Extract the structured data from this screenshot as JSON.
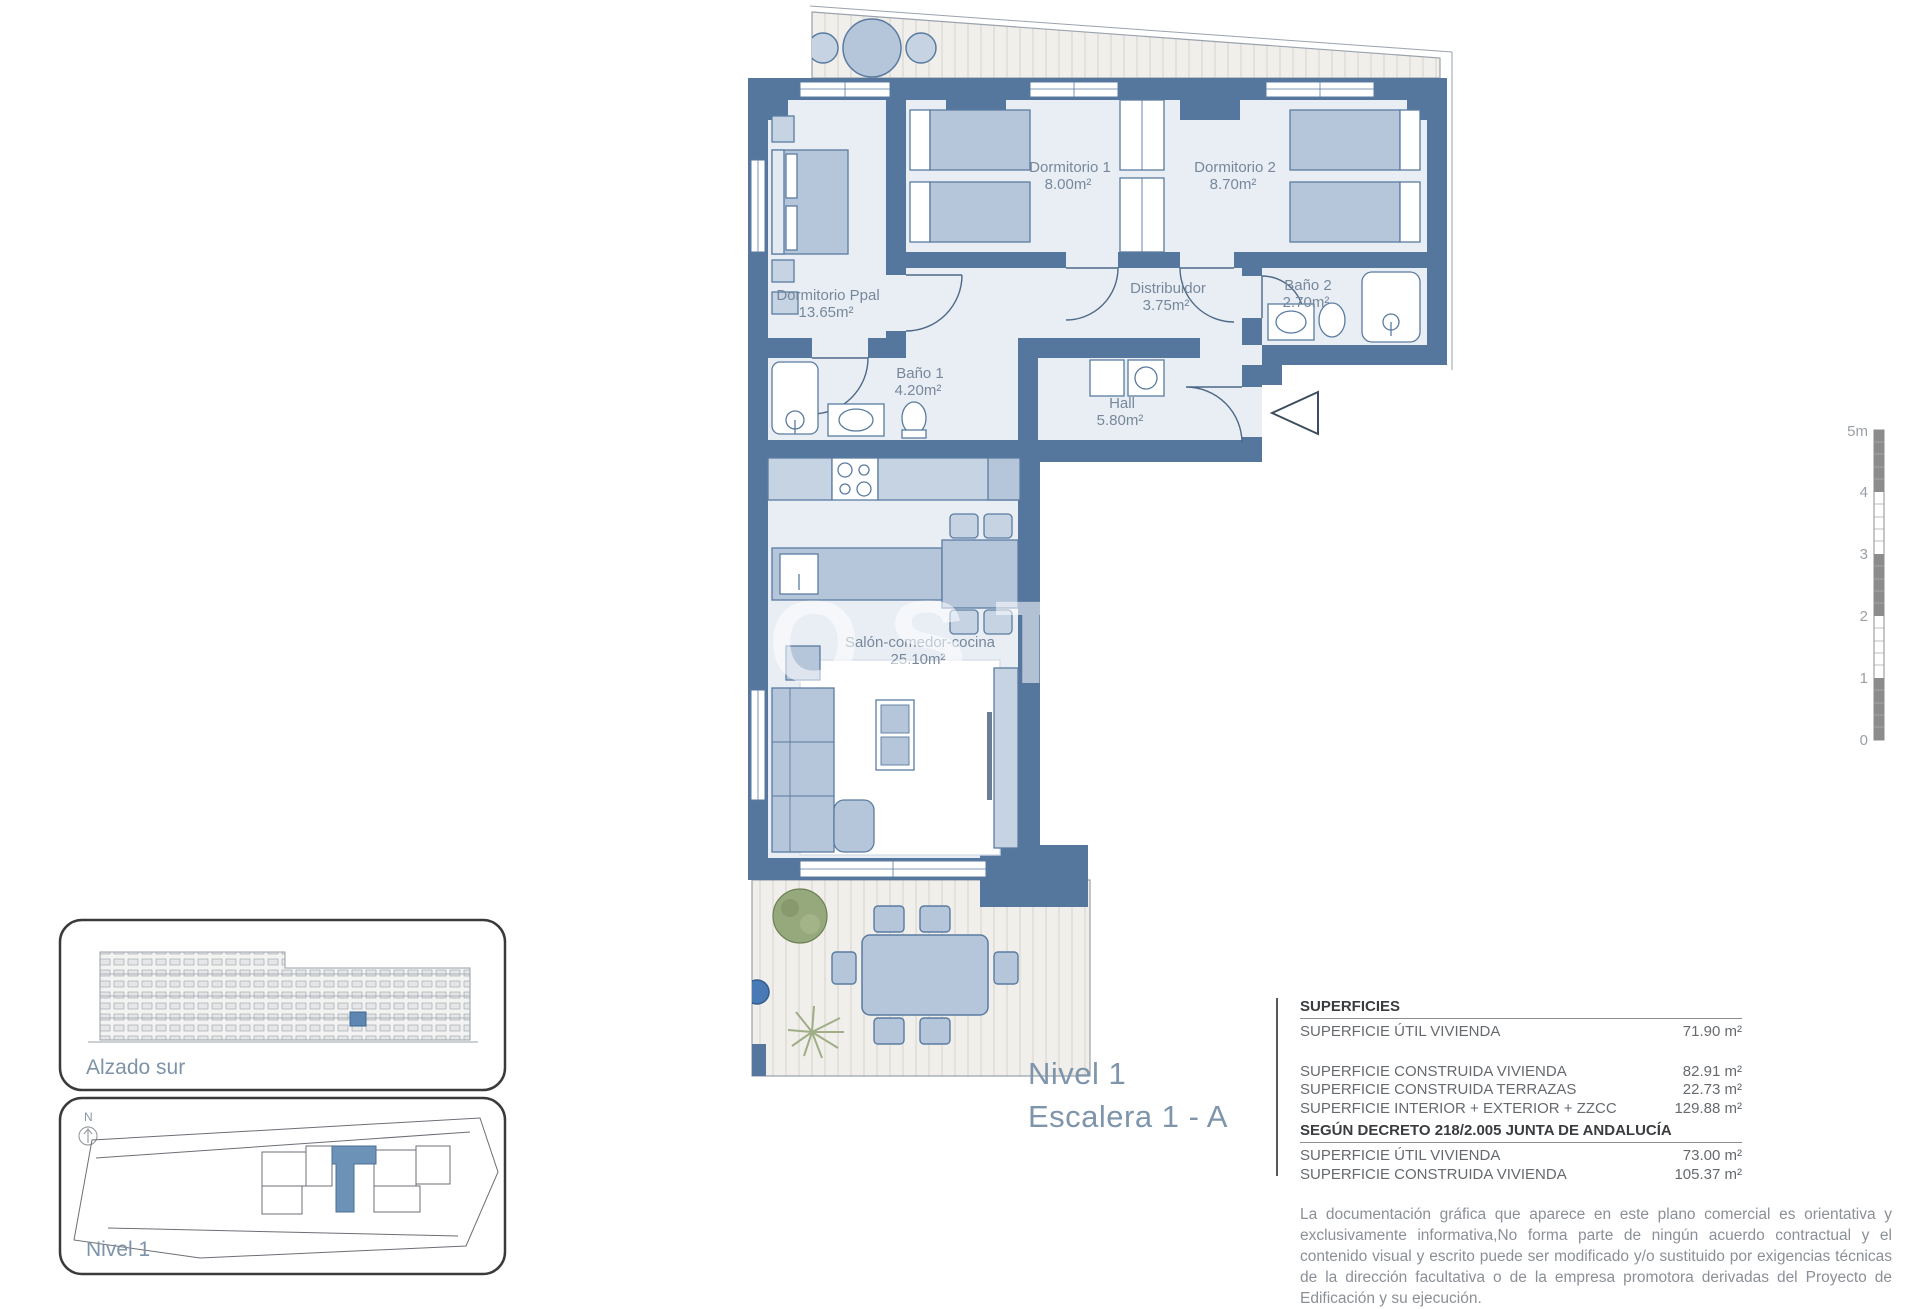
{
  "plan": {
    "title_line1": "Nivel 1",
    "title_line2": "Escalera 1 - A",
    "watermark": "COSTAG",
    "watermark2": "ES",
    "rooms": {
      "dormitorio_ppal": {
        "name": "Dormitorio Ppal",
        "area": "13.65m²"
      },
      "dormitorio_1": {
        "name": "Dormitorio 1",
        "area": "8.00m²"
      },
      "dormitorio_2": {
        "name": "Dormitorio 2",
        "area": "8.70m²"
      },
      "bano_1": {
        "name": "Baño 1",
        "area": "4.20m²"
      },
      "bano_2": {
        "name": "Baño 2",
        "area": "2.70m²"
      },
      "distribuidor": {
        "name": "Distribuidor",
        "area": "3.75m²"
      },
      "hall": {
        "name": "Hall",
        "area": "5.80m²"
      },
      "salon": {
        "name": "Salón-comedor-cocina",
        "area": "25.10m²"
      }
    },
    "colors": {
      "wall": "#55769d",
      "floor": "#e9eef4",
      "furniture": "#b5c6da",
      "highlight": "#6d92b8"
    }
  },
  "scale_bar": {
    "unit_top": "5m",
    "labels": [
      "5m",
      "4",
      "3",
      "2",
      "1",
      "0"
    ]
  },
  "insets": {
    "elevation_label": "Alzado sur",
    "siteplan_label": "Nivel 1",
    "north_label": "N"
  },
  "surfaces": {
    "header": "SUPERFICIES",
    "rows1": [
      {
        "label": "SUPERFICIE ÚTIL VIVIENDA",
        "value": "71.90 m²"
      }
    ],
    "rows2": [
      {
        "label": "SUPERFICIE CONSTRUIDA VIVIENDA",
        "value": "82.91 m²"
      },
      {
        "label": "SUPERFICIE CONSTRUIDA TERRAZAS",
        "value": "22.73 m²"
      },
      {
        "label": "SUPERFICIE INTERIOR + EXTERIOR + ZZCC",
        "value": "129.88 m²"
      }
    ],
    "header2": "SEGÚN DECRETO 218/2.005 JUNTA DE ANDALUCÍA",
    "rows3": [
      {
        "label": "SUPERFICIE ÚTIL VIVIENDA",
        "value": "73.00 m²"
      },
      {
        "label": "SUPERFICIE CONSTRUIDA VIVIENDA",
        "value": "105.37 m²"
      }
    ]
  },
  "disclaimer": "La documentación gráfica que aparece en este plano comercial es orientativa y exclusivamente informativa,No forma parte de ningún acuerdo contractual y el contenido visual y escrito puede ser modificado y/o sustituido por exigencias técnicas de la dirección facultativa o de la empresa promotora derivadas del Proyecto de Edificación y su ejecución."
}
